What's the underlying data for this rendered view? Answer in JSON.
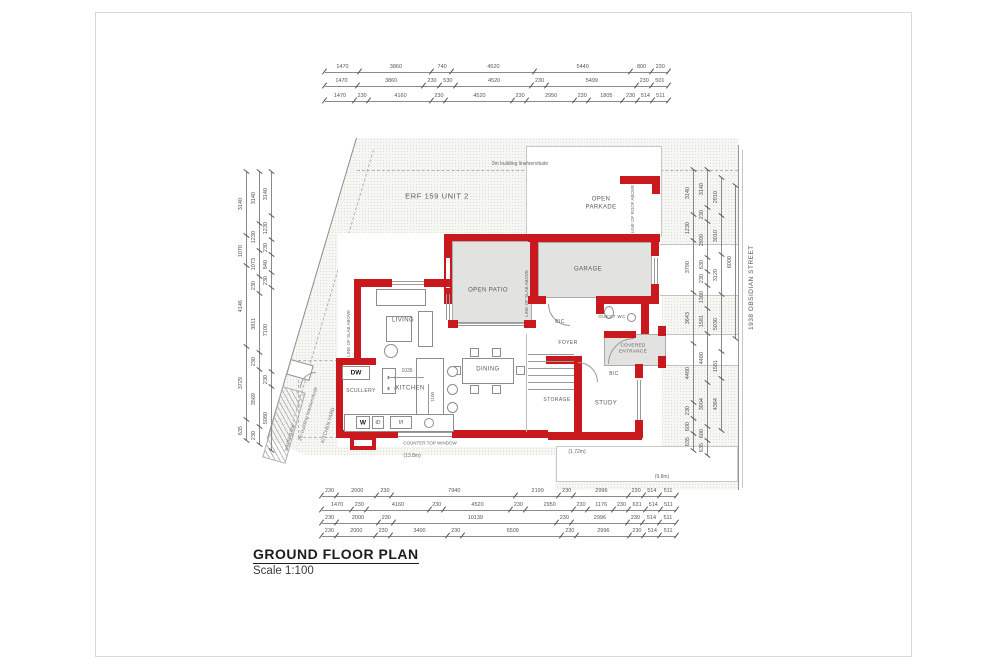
{
  "title_block": {
    "title": "GROUND FLOOR PLAN",
    "scale": "Scale 1:100"
  },
  "site": {
    "erf_label": "ERF 159 UNIT 2",
    "street_label": "1938 OBSIDIAN STREET",
    "building_line_top": "3m building line/servitude",
    "building_line_left": "2m building line/servitude",
    "kitchen_yard_label": "KITCHEN YARD",
    "washing_line_label": "washing line"
  },
  "rooms": {
    "living": "LIVING",
    "dining": "DINING",
    "kitchen": "KITCHEN",
    "scullery": "SCULLERY",
    "study": "STUDY",
    "foyer": "FOYER",
    "storage": "STORAGE",
    "garage": "GARAGE",
    "open_patio": "OPEN PATIO",
    "open_parkade_1": "OPEN",
    "open_parkade_2": "PARKADE",
    "guest_wc": "GUEST WC",
    "covered_entrance_1": "COVERED",
    "covered_entrance_2": "ENTRANCE",
    "bic_1": "BIC",
    "bic_2": "BIC"
  },
  "annotations": {
    "slab_above_left": "LINE OF SLAB ABOVE",
    "slab_above_right": "LINE OF SLAB ABOVE",
    "roof_above": "LINE OF ROOF ABOVE",
    "counter_top_window": "COUNTER TOP WINDOW",
    "len_13_8": "(13.8m)",
    "len_1_72": "(1.72m)",
    "len_9_8": "(9.8m)",
    "dim_1035": "1035",
    "dim_1100": "1100",
    "appl_w": "W",
    "appl_td": "tD",
    "appl_ff": "f/f",
    "appl_dw": "DW"
  },
  "dimensions": {
    "top_rows": [
      [
        "1470",
        "3860",
        "740",
        "4520",
        "5440",
        "800",
        "230"
      ],
      [
        "1470",
        "3860",
        "230",
        "530",
        "4520",
        "230",
        "5499",
        "230",
        "501"
      ],
      [
        "1470",
        "230",
        "4160",
        "230",
        "4520",
        "230",
        "2950",
        "230",
        "1805",
        "230",
        "514",
        "511"
      ]
    ],
    "bottom_rows": [
      [
        "230",
        "2000",
        "230",
        "7940",
        "2199",
        "230",
        "2996",
        "230",
        "514",
        "511"
      ],
      [
        "1470",
        "230",
        "4160",
        "230",
        "4520",
        "230",
        "2950",
        "230",
        "1176",
        "230",
        "631",
        "514",
        "511"
      ],
      [
        "230",
        "2000",
        "230",
        "10139",
        "230",
        "2996",
        "230",
        "514",
        "511"
      ],
      [
        "230",
        "2000",
        "230",
        "3400",
        "230",
        "6509",
        "230",
        "2996",
        "230",
        "514",
        "511"
      ]
    ],
    "left_cols": [
      [
        "3140",
        "1070",
        "4146",
        "3729",
        "635"
      ],
      [
        "3140",
        "1230",
        "1073",
        "230",
        "3811",
        "230",
        "3569",
        "230"
      ],
      [
        "3140",
        "1230",
        "230",
        "840",
        "230",
        "7100",
        "230",
        "5080"
      ]
    ],
    "right_cols": [
      [
        "3140",
        "1230",
        "3790",
        "3643",
        "4480",
        "230",
        "600",
        "635"
      ],
      [
        "3140",
        "230",
        "2890",
        "630",
        "230",
        "1300",
        "1581",
        "4480",
        "3904",
        "600",
        "635"
      ],
      [
        "2910",
        "3010",
        "3120",
        "5030",
        "1581",
        "4364"
      ]
    ],
    "street_dim": [
      "6000"
    ]
  }
}
